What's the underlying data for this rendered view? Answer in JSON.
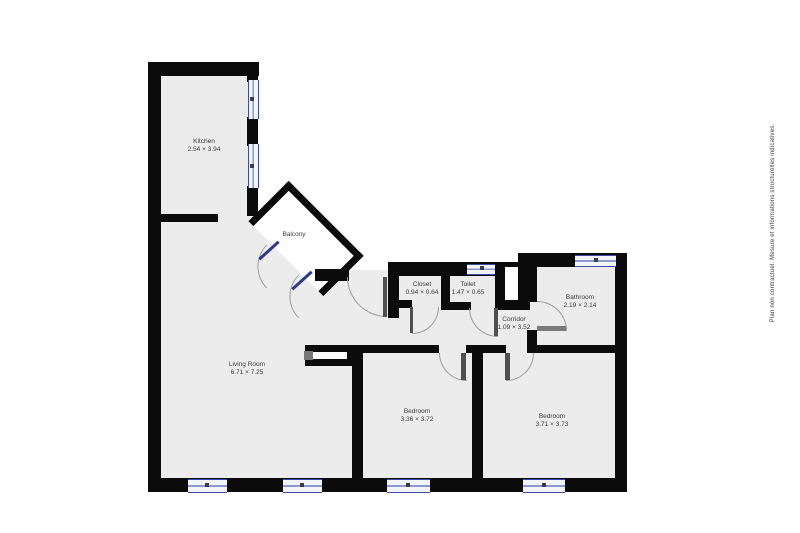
{
  "floor_plan": {
    "rooms": {
      "kitchen": {
        "name": "Kitchen",
        "dims": "2.54 × 3.94"
      },
      "balcony": {
        "name": "Balcony",
        "dims": ""
      },
      "closet": {
        "name": "Closet",
        "dims": "0.94 × 0.64"
      },
      "toilet": {
        "name": "Toilet",
        "dims": "1.47 × 0.65"
      },
      "bathroom": {
        "name": "Bathroom",
        "dims": "2.19 × 2.14"
      },
      "corridor": {
        "name": "Corridor",
        "dims": "1.09 × 3.52"
      },
      "living_room": {
        "name": "Living Room",
        "dims": "6.71 × 7.25"
      },
      "bedroom_1": {
        "name": "Bedroom",
        "dims": "3.36 × 3.72"
      },
      "bedroom_2": {
        "name": "Bedroom",
        "dims": "3.71 × 3.73"
      }
    },
    "disclaimer": "Plan non contractuel. Mesure et informations structurelles indicatives.",
    "colors": {
      "wall": "#0b0b0b",
      "room_fill": "#ececec",
      "window_blue": "#3c4ba8",
      "window_fill": "#f2f4fc",
      "door_arc": "#9c9c9c",
      "door_leaf": "#4f4f4f",
      "balcony_door": "#2d3a8c",
      "text": "#3b3b3b"
    }
  }
}
